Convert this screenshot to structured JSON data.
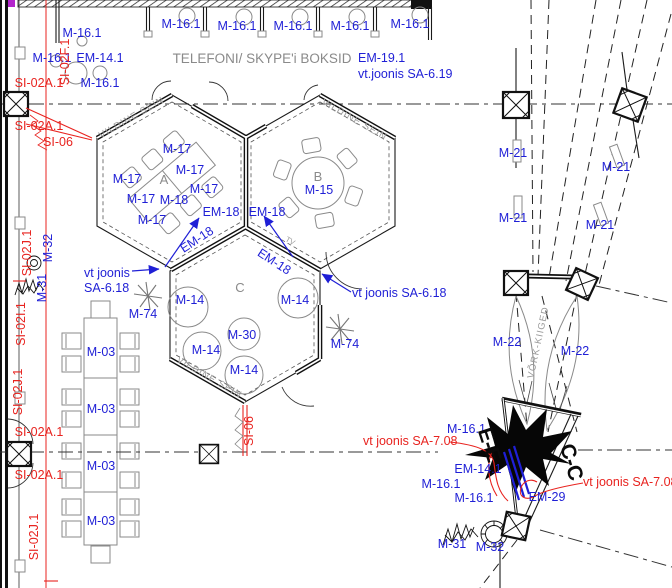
{
  "drawing": {
    "booths": {
      "title": "TELEFONI/ SKYPE'i BOKSID",
      "unit": "M-16.1",
      "note1": "EM-19.1",
      "note2": "vt.joonis SA-6.19"
    },
    "rooms": {
      "a": "A",
      "b": "B",
      "c": "C"
    },
    "walls": {
      "felt": "VILDINE SEIN",
      "swings": "VÕRK-KIIGED",
      "tv": "TV"
    },
    "marks": {
      "m03": "M-03",
      "m14": "M-14",
      "m15": "M-15",
      "m16": "M-16.1",
      "m17": "M-17",
      "m18": "M-18",
      "m21": "M-21",
      "m22": "M-22",
      "m30": "M-30",
      "m31": "M-31",
      "m32": "M-32",
      "m74": "M-74",
      "em14": "EM-14.1",
      "em18": "EM-18",
      "em29": "EM-29"
    },
    "site_refs": {
      "si02f": "SI-02F.1",
      "si02a": "SI-02A.1",
      "si02i": "SI-02I.1",
      "si02j": "SI-02J.1",
      "si06": "SI-06"
    },
    "notes": {
      "sa618_line1": "vt joonis",
      "sa618_line2": "SA-6.18",
      "sa618": "vt joonis SA-6.18",
      "sa708": "vt joonis SA-7.08"
    },
    "sections": {
      "ee": "E-E",
      "cc": "C-C"
    },
    "colors": {
      "label_blue": "#1f1fd6",
      "ref_red": "#e8231f",
      "text_gray": "#8a8a8a",
      "line_black": "#1a1a1a",
      "corner_mark_purple": "#b326cc"
    }
  }
}
